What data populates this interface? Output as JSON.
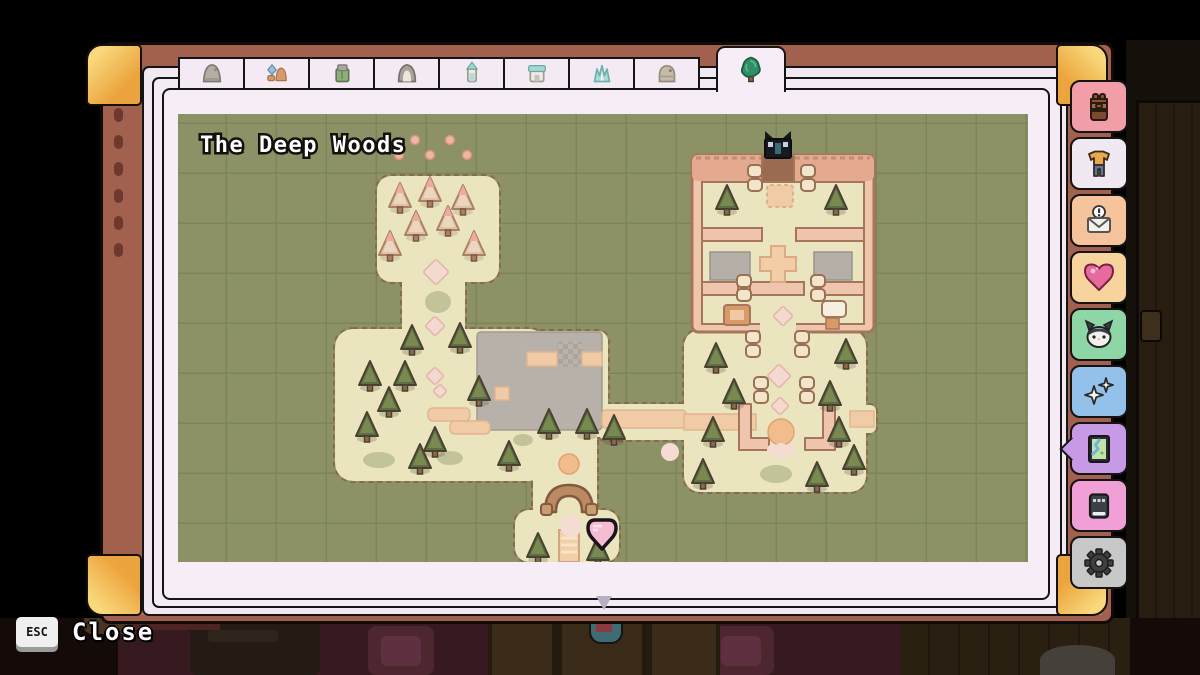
{
  "journal": {
    "tabs": [
      {
        "name": "tab-stone-shrine",
        "icon": "stone-mound-icon"
      },
      {
        "name": "tab-camp",
        "icon": "figures-icon"
      },
      {
        "name": "tab-green-shrine",
        "icon": "green-shrine-icon"
      },
      {
        "name": "tab-cave-shrine",
        "icon": "arch-shrine-icon"
      },
      {
        "name": "tab-tower",
        "icon": "bell-tower-icon"
      },
      {
        "name": "tab-house",
        "icon": "house-icon"
      },
      {
        "name": "tab-ice-crystals",
        "icon": "crystals-icon"
      },
      {
        "name": "tab-dome-shrine",
        "icon": "dome-icon"
      }
    ],
    "active_tab": {
      "name": "tab-deep-woods",
      "icon": "green-bush-icon"
    }
  },
  "sidebar": {
    "buttons": [
      {
        "name": "inventory-button",
        "icon": "backpack-icon",
        "bg": "#f29ea8",
        "active": false
      },
      {
        "name": "clothing-button",
        "icon": "clothing-icon",
        "bg": "#f1e9f1",
        "active": false
      },
      {
        "name": "mail-button",
        "icon": "mail-icon",
        "bg": "#f5c39c",
        "active": false
      },
      {
        "name": "relationships-button",
        "icon": "heart-icon",
        "bg": "#f7d49e",
        "active": false
      },
      {
        "name": "cat-button",
        "icon": "cat-icon",
        "bg": "#8fd6a7",
        "active": false
      },
      {
        "name": "skills-button",
        "icon": "sparkles-icon",
        "bg": "#93c1e9",
        "active": false
      },
      {
        "name": "map-button",
        "icon": "map-icon",
        "bg": "#c79ae6",
        "active": true
      },
      {
        "name": "machine-button",
        "icon": "device-icon",
        "bg": "#f0a0d6",
        "active": false
      },
      {
        "name": "settings-button",
        "icon": "gear-icon",
        "bg": "#c8c8c8",
        "active": false
      }
    ]
  },
  "map": {
    "title": "The Deep Woods",
    "palette": {
      "ground": "#8c9266",
      "grid": "#7b8558",
      "land": "#eae5be",
      "land_border": "#8a6a4e",
      "path": "#f1cba6",
      "wall": "#efc6ad",
      "wall_border": "#a5765c",
      "plaza": "#b7b1a9",
      "marker": "#f6bcd4",
      "tree": "#5e6e46",
      "pink_tree": "#efa9a1"
    },
    "features": {
      "pink_dots": [
        [
          237,
          26
        ],
        [
          272,
          26
        ],
        [
          221,
          41
        ],
        [
          252,
          41
        ],
        [
          289,
          41
        ]
      ],
      "pink_trees": [
        [
          222,
          84
        ],
        [
          252,
          78
        ],
        [
          285,
          86
        ],
        [
          238,
          112
        ],
        [
          270,
          107
        ],
        [
          212,
          132
        ],
        [
          296,
          132
        ]
      ],
      "green_trees": [
        [
          234,
          226
        ],
        [
          282,
          224
        ],
        [
          192,
          262
        ],
        [
          227,
          262
        ],
        [
          211,
          288
        ],
        [
          189,
          313
        ],
        [
          257,
          328
        ],
        [
          242,
          345
        ],
        [
          301,
          277
        ],
        [
          331,
          342
        ],
        [
          371,
          310
        ],
        [
          409,
          310
        ],
        [
          436,
          316
        ],
        [
          549,
          86
        ],
        [
          658,
          86
        ],
        [
          538,
          244
        ],
        [
          668,
          240
        ],
        [
          556,
          280
        ],
        [
          652,
          282
        ],
        [
          535,
          318
        ],
        [
          661,
          318
        ],
        [
          676,
          346
        ],
        [
          525,
          360
        ],
        [
          639,
          363
        ],
        [
          360,
          434
        ],
        [
          420,
          437
        ]
      ],
      "pillars": [
        [
          577,
          64
        ],
        [
          630,
          64
        ],
        [
          566,
          174
        ],
        [
          640,
          174
        ],
        [
          575,
          230
        ],
        [
          624,
          230
        ],
        [
          583,
          276
        ],
        [
          629,
          276
        ]
      ],
      "diamonds": [
        {
          "x": 258,
          "y": 158,
          "s": 13
        },
        {
          "x": 257,
          "y": 212,
          "s": 10
        },
        {
          "x": 257,
          "y": 262,
          "s": 9
        },
        {
          "x": 262,
          "y": 277,
          "s": 7
        },
        {
          "x": 605,
          "y": 202,
          "s": 10
        },
        {
          "x": 601,
          "y": 262,
          "s": 12
        },
        {
          "x": 602,
          "y": 292,
          "s": 9
        }
      ],
      "green_blobs": [
        {
          "x": 260,
          "y": 188,
          "rx": 13,
          "ry": 11
        },
        {
          "x": 201,
          "y": 346,
          "rx": 16,
          "ry": 8
        },
        {
          "x": 272,
          "y": 344,
          "rx": 13,
          "ry": 7
        },
        {
          "x": 598,
          "y": 360,
          "rx": 16,
          "ry": 9
        },
        {
          "x": 345,
          "y": 326,
          "rx": 10,
          "ry": 6
        }
      ],
      "orange_spots": [
        {
          "x": 391,
          "y": 350,
          "r": 10
        },
        {
          "x": 603,
          "y": 318,
          "r": 13
        }
      ],
      "pink_spots": [
        {
          "x": 393,
          "y": 412,
          "r": 11
        },
        {
          "x": 595,
          "y": 336,
          "r": 6
        },
        {
          "x": 603,
          "y": 337,
          "r": 8
        },
        {
          "x": 612,
          "y": 336,
          "r": 6
        },
        {
          "x": 492,
          "y": 338,
          "r": 9
        }
      ],
      "player_marker": {
        "x": 424,
        "y": 419
      },
      "entrance_marker": {
        "x": 600,
        "y": 33
      }
    }
  },
  "footer": {
    "esc_key": "ESC",
    "close_label": "Close"
  }
}
